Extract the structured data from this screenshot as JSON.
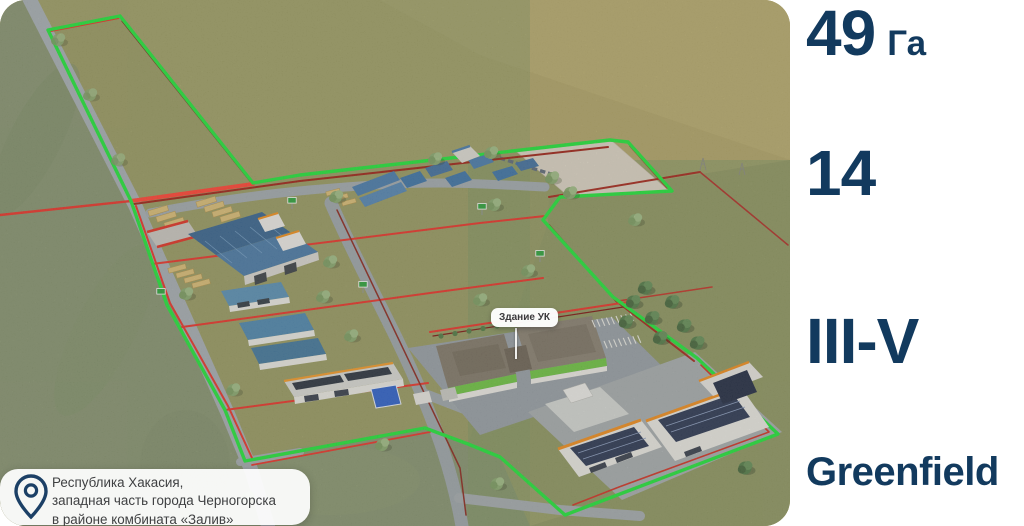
{
  "map": {
    "building_label": "Здание УК"
  },
  "location": {
    "icon": "location-pin-icon",
    "line1": "Республика Хакасия,",
    "line2": "западная часть города Черногорска",
    "line3": "в районе комбината «Залив»"
  },
  "stats": {
    "area": {
      "value": "49",
      "unit": "Га"
    },
    "plots": {
      "value": "14"
    },
    "hazard_class": {
      "value": "III-V"
    },
    "site_type": {
      "value": "Greenfield"
    }
  },
  "colors": {
    "stat_text_navy": "#123A5E",
    "boundary_green": "#23E43B",
    "boundary_red_bright": "#E8352A",
    "boundary_red_dark": "#7F1712",
    "terrain_tan": "#B1A468",
    "card_text": "#3F4042"
  }
}
